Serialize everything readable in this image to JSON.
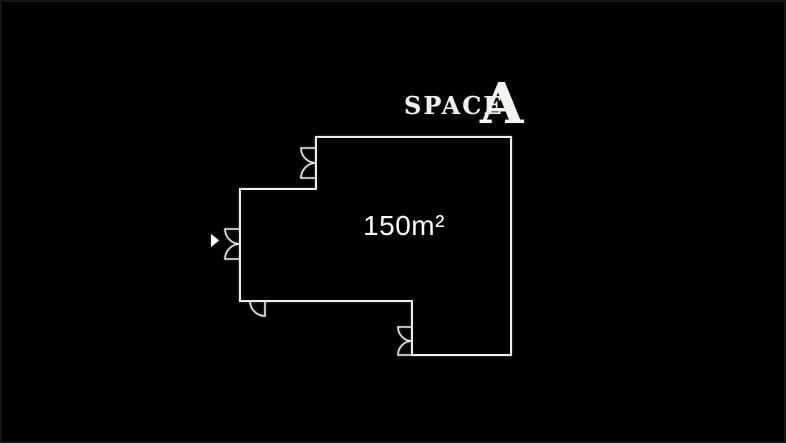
{
  "page": {
    "background_color": "#000000",
    "edge_color": "#141414"
  },
  "title": {
    "word": "SPACE",
    "letter": "A",
    "color": "#f2f0ec"
  },
  "floor_plan": {
    "area_label": "150m²",
    "wall_color": "#ededed",
    "door_color": "#e8e8e8",
    "label_color": "#fdfdfd",
    "cursor_color": "#ffffff",
    "icons": [
      "double-door-icon-top",
      "double-door-icon-left",
      "single-door-icon-bottom-left",
      "double-door-icon-bottom",
      "cursor-arrow-icon"
    ]
  }
}
